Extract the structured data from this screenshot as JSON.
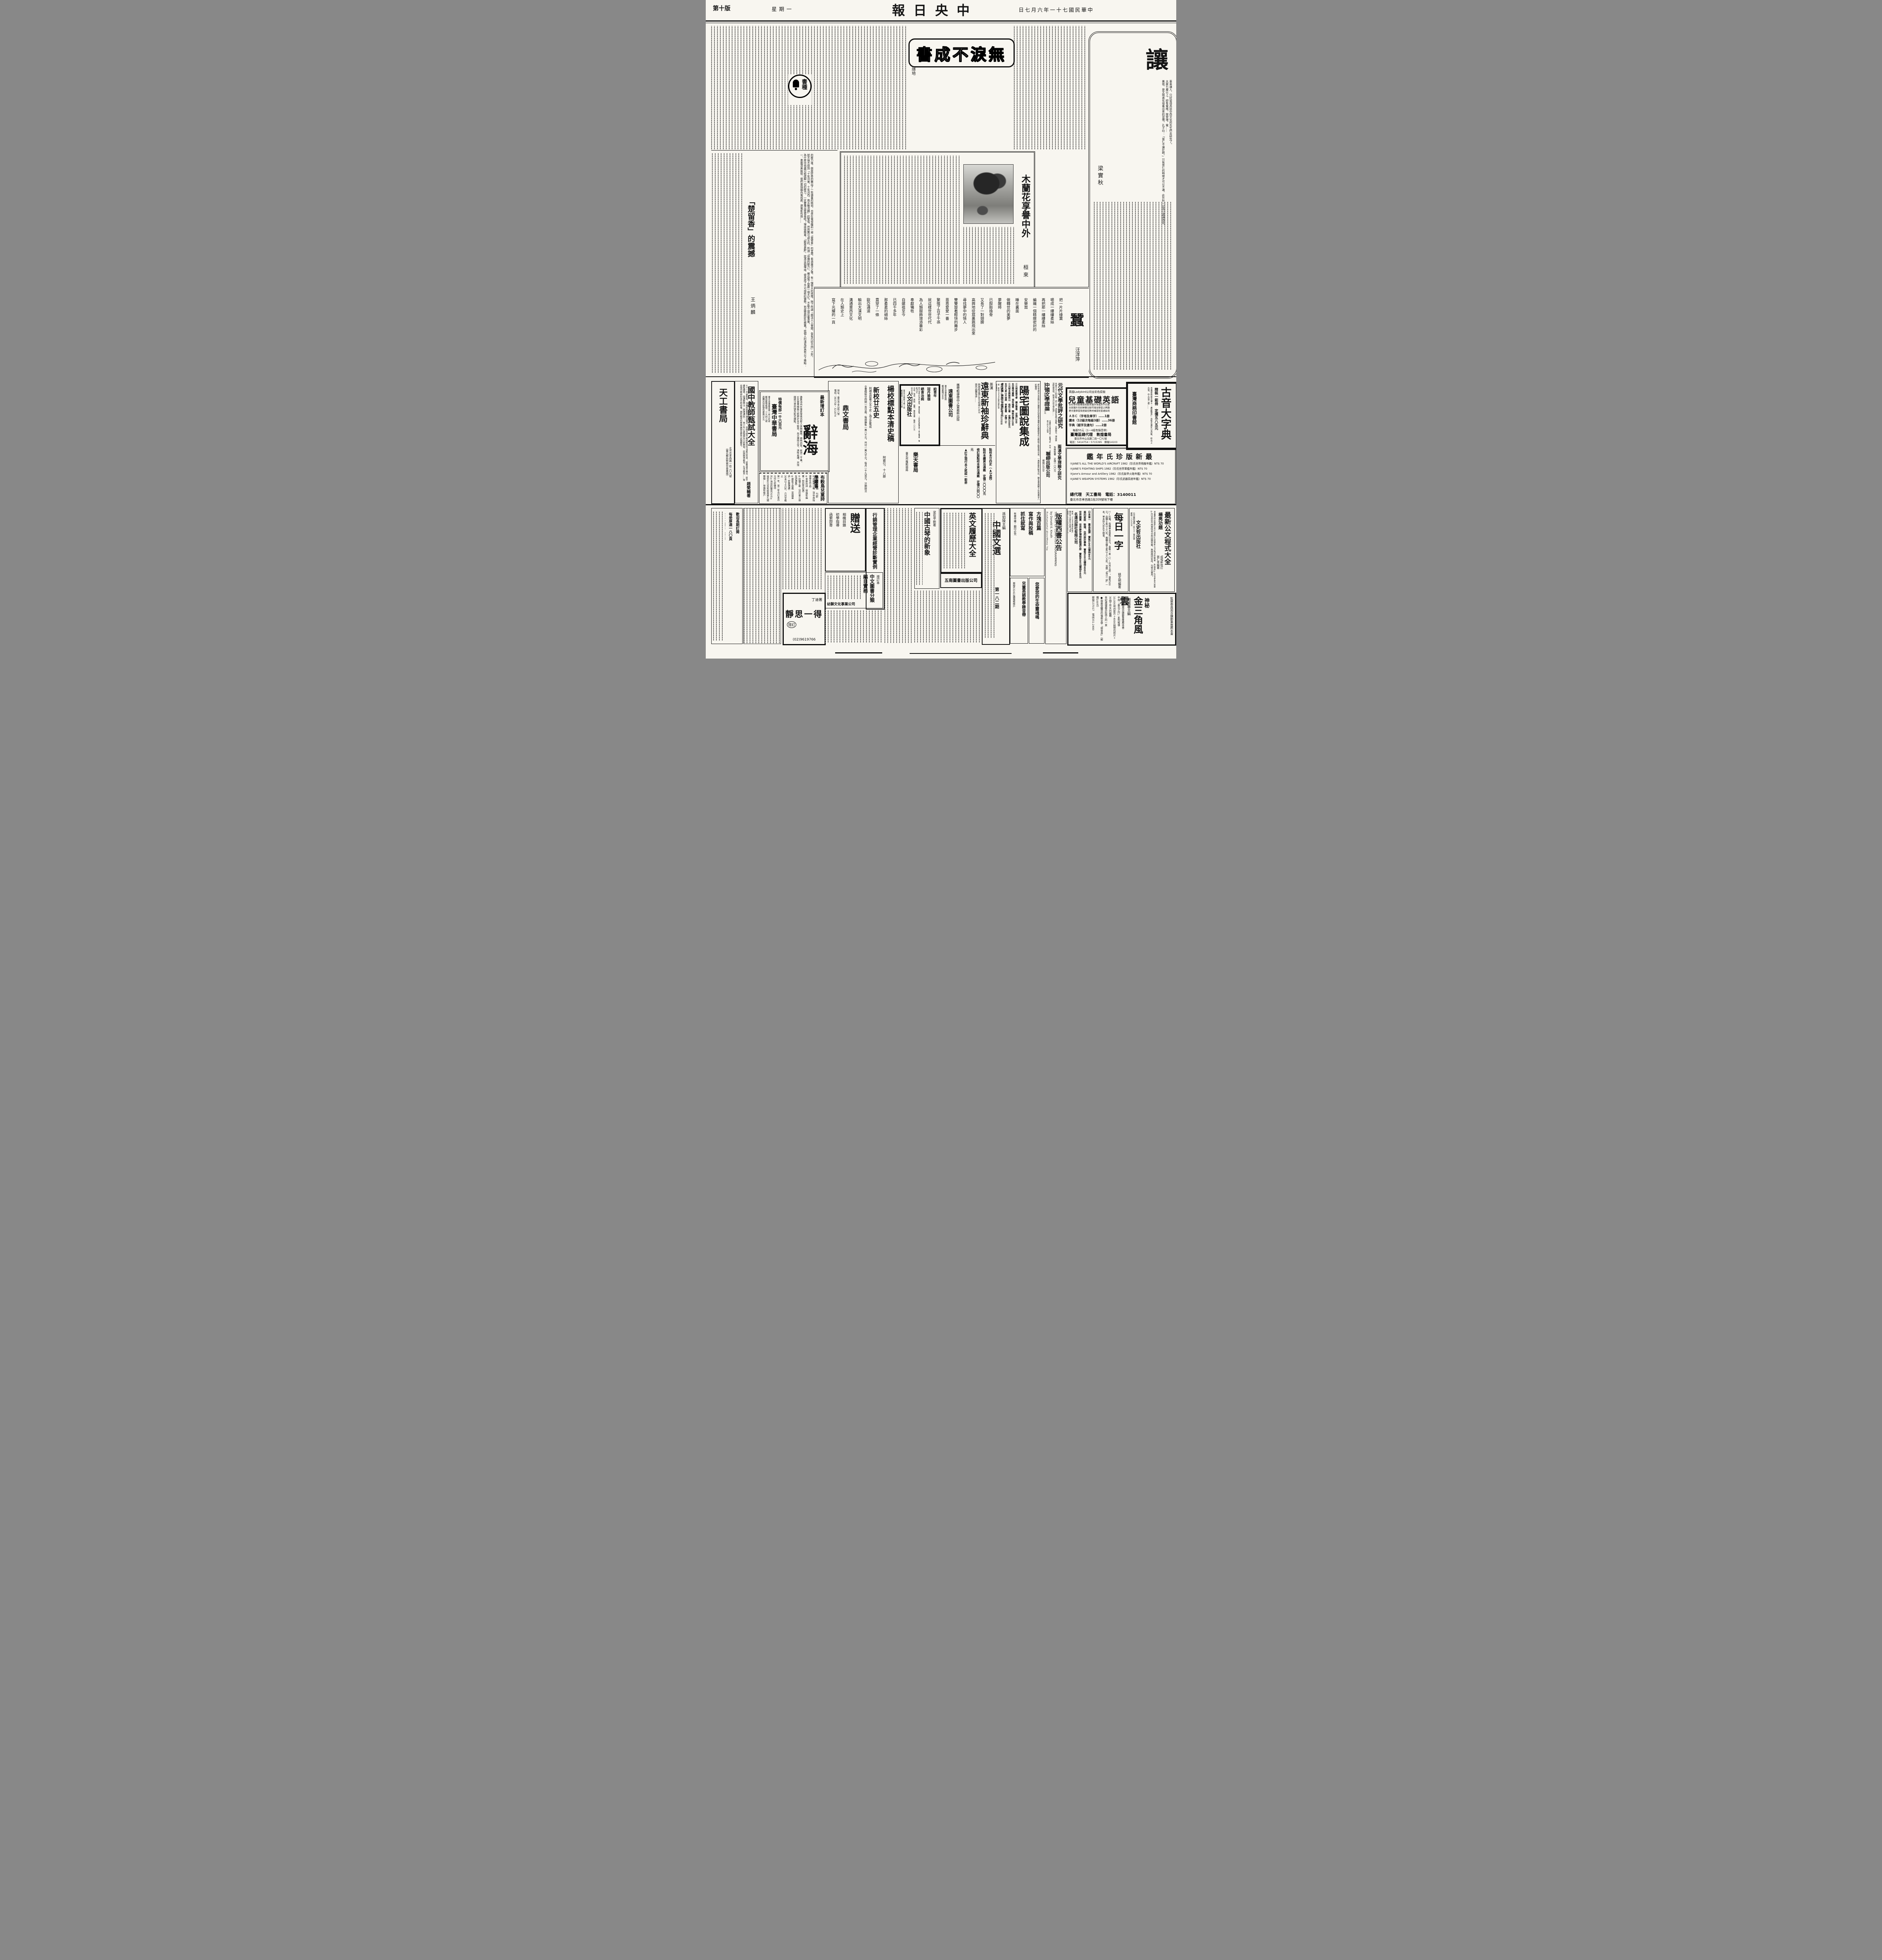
{
  "header": {
    "edition": "第十版",
    "weekday": "星期一",
    "masthead_display": "報日央中",
    "date_display": "日七月六年一十七國民華中"
  },
  "seal": {
    "text": "書種"
  },
  "art": {
    "rang": {
      "title": "讓",
      "author": "梁實秋",
      "body": [
        "車車讓人，只好留待高談中西文化的先生們去研究了。",
        "大廈七層以上，卽有電梯。按常理，電……",
        "美德，是文明進化培養出來的習慣。孔子曰：「當仁不讓於師。」只有當仁的時候才可以不讓。此外則一定當以謙讓為宜。"
      ]
    },
    "wulei": {
      "title_display": "書成不淚無",
      "author": "隱地"
    },
    "mulan": {
      "title": "木蘭花享譽中外",
      "author": "桓來"
    },
    "chu": {
      "title": "「楚留香」的震撼",
      "author": "王炳麟",
      "body": [
        "的壓力後，倒是好奇的騰出了一些讀書的時刻，也坐在電視機前一窺「楚留香」的堂奧，看過幾次之後，有一個很大的感慨，除了所謂「戲法人人會變，各有巧妙不同」之外，",
        "就不得不想到「十年河東，十年河西，風水輪流轉」的警惕，然而無可諱言的，所謂「停播的壓力」，確也幫了楚劇一個大忙，不能不說這是事實。",
        "為什麼中視盡可能疏解一切的壓力，一定要播出楚留香呢？理由很簡單，「觀眾喜歡」，就憑這個理由，便造成了不可排拒的優勢，到底楚劇好在那裏？就個人的淺見認為有以下幾點：",
        "一、畫面清美脫俗：我們覺得國內電視劇、連電影包括……"
      ]
    },
    "poem": {
      "title": "蠶",
      "author": "汪洋萍",
      "lines": [
        "把一片片綠葉",
        "嚼成一縷縷柔絲",
        "再把那一縷縷柔絲",
        "編織一個精緻密封的",
        "安樂窩",
        "睡在裏面",
        "做轉世的美夢",
        "夢醒時",
        "已脫胎換骨",
        "又長了一對翅膀",
        "高興地從窩裏跳飛出來",
        "尋找夢中的情人",
        "雙雙旋着輕快的舞步",
        "恩恩愛愛一番",
        "繁殖了百子千孫",
        "就這樣世世代代",
        "為人類服飾增添華彩",
        "奉獻犧牲",
        "自嫘祖至今",
        "已四千多年",
        "那柔柔的細絲",
        "貫穿了一條",
        "歐亞通道",
        "輸出大漢文明",
        "溝通東西文化",
        "在人類史上",
        "寫下光耀的一頁"
      ]
    }
  },
  "top": {
    "tiangong": {
      "name": "天工書局",
      "lines": [
        "北市忠孝西路一段二〇九號",
        "（臺北郵局對面中華書城）"
      ]
    },
    "guozhong": {
      "title": "國中教師甄試大全",
      "author": "趙榮輔著",
      "body": "七十一年最新版，本書依據臺灣省及臺北、高雄市國中教師甄試科目編訂而成：國教基本概念、國中課程標準、普通教學法（原理通則）、青少年心身發展及公民教育、民族精神教育、生活教育……等並增列教師的責任和修養，國民教育科教案編製及歷年試題解答。"
    },
    "cihai": {
      "pre": "最新增訂本",
      "title": "辭海",
      "body": "邀集海內外專家學者百餘人參與編務，費時四年，耗資二千萬。16K豪華精裝三鉅册計五千餘頁，內文選排大字，清晰易讀，另加國語注音符號及新式標點。",
      "price": "特價每部一千六百元",
      "pub": "臺灣中華書局",
      "lines": [
        "臺北市重慶南路一段九四號",
        "郵政劃撥帳號：三九四二號",
        "函購另加掛號包裹費56元"
      ]
    },
    "bugu": {
      "title": "布穀鳥兒童詩學叢書",
      "sub": "林煥彰主編　七折",
      "items": [
        "③母鴨帶小鴨（洪中周指導學生作品）",
        "④季節的詩（林煥彰編著・附四季詩選）",
        "⑤鈴鐺之歌（沈玲裳小朋友詩選集）",
        "⑥跟影子遊戲（英國童詩・舒蘭選譯）",
        "30本以上六折，六月廿截止",
        "第一年、第二年合訂本百元均七折優待",
        "另①海浪的聲音70元②祕密60元及布穀鳥第九期",
        "郵撥……林煥彰帳戶"
      ]
    },
    "dingwen": {
      "t1": "楊校標點本清史稿",
      "s1": "附索引，十八册",
      "t2": "新校廿五史",
      "s2": "附補充原著之五十史・為正史集成",
      "body": "全書精裝廿四開一百廿册，每部廉售一萬八千元，共付一萬九千元，每月一千九百元，分期辦法",
      "pub": "鼎文書局",
      "lines": [
        "地址：臺北市金山街八號",
        "電話：393758・321874"
      ]
    },
    "renwen": {
      "titles": [
        "給青年",
        "冠丹瑜珈",
        "絕食治病",
        "斷食",
        "我的絕食心得"
      ],
      "details": [
        "時代青年的良師益友，暮鼓晨鐘。—談德智體羣美—朱孟實著　每册50元",
        "去病、強身、美容、益壽。陳盈潔著　每册一〇〇元",
        "段木干著　每册50元",
        "55篇實驗　每册50元",
        "郭金水譯　每册50元"
      ],
      "pub": "人文出版社",
      "lines": [
        "臺中市忠明路20巷11號",
        "郵政劃匯二八〇〇〇號"
      ]
    },
    "letian": {
      "items": [
        "點校本廿四史（▲24開）",
        "點校本續資治通鑑　定價二〇〇〇元",
        "修訂版點校本資治通鑑　定價六四〇〇元",
        "▲訂正現行本之訛誤一鉅册"
      ],
      "pub": "樂天書局",
      "addr": "臺北市羅斯福路"
    },
    "yuandong": {
      "tag": "攜帶輕便懷中之寶最新出版",
      "small": "英漢",
      "title": "遠東新袖珍辭典",
      "body": [
        "辭典紙定價180元特價135元",
        "國內函購每册……"
      ],
      "pub": "遠東圖書公司",
      "lines": [
        "臺北市重慶南路",
        "郵政劃撥5669"
      ]
    },
    "yangzhai": {
      "title": "陽宅圖說集成",
      "preview": "把住宅與河水道路山丘橋樑巨石怪樹池塘等的各種關係均以精繪之圖表現出來，一看卽能判斷吉凶，購本書再購下列各書享八折優待",
      "note": "預約陸佰元至月底止　鐘友聯編・梁詩涵繪圖",
      "books": [
        "三元飛星陽宅學　鐘友聯著　定價1200",
        "玄空陽宅闡微　張哲鳴著　精裝定價1200",
        "三元秘本劈破荊山　侯松江著　定價2500元",
        "玄空九星山水祕典　李獻堂著　定價二千",
        "樓宅真機　精裝巨册特價1200元",
        "祕笈救敗全書　楊救貧著　售三千元",
        "三元修行法語64頁郵3元寄臺北51附54信箱"
      ],
      "contact": [
        "贈　郵撥104266石室出版社收",
        "書目備索"
      ]
    },
    "lianjing": {
      "b1": "元代文學批評之研究",
      "body1": "本書凡元人的別集、詩人評、詞曲評皆盡力蒐集，大量論文，博採衆說較論長短，盼望元代的文學批評……",
      "b2": "中國文學理論",
      "credit2": "劉若愚著・杜國清譯　定價一五〇元",
      "note2": "全國各大書局均售・郵購9折　門市：北市新生南路三段九十四號",
      "b3": "兩漢文學理論之研究",
      "credit3": "朱榮智著　定價一〇〇元",
      "pub": "聯經出版公司",
      "post": "郵撥10559"
    },
    "ladybird": {
      "header": "英國Ladybird公司全彩色原版",
      "title": "兒童基礎英語",
      "lines": [
        "從初學到能看能說能寫循序漸進系列完整",
        "全部圖片色彩鮮艷生動可增加學習之興趣",
        "是兒童學習英語最佳教材補習班普遍採用"
      ],
      "items": [
        "ＡＢＣ（字母及單字）……1册",
        "讀本（12級次每級3册）……36册",
        "字典（認字及連句）……2册"
      ],
      "note": "每册55元（1—4級有錄音帶）",
      "agent": "臺灣區總代理　敦煌書局",
      "addr": "臺北市中山北路二段一〇七號",
      "tel": "電話：5414754・5715395　郵撥14103"
    },
    "guyin": {
      "title": "古音大字典",
      "sub": "精裝一鉅冊　定價五八五元",
      "body": "本書係根據沈兼士「廣韻聲系」及黎氏書加以改編，綜合上古音、中古音二者……",
      "pub": "臺灣商務印書館"
    },
    "janes": {
      "title_display": "鑑年氏珍版新最",
      "items": [
        "①JANE'S ALL THE WORLD'S AIRCRAFT 1982（珍氏世界飛機年鑑）NT$ 70",
        "②JANE'S FIGHTING SHIPS 1982（珍氏世界軍艦年鑑）NT$ 70",
        "③Jane's Armour and Artillery 1982（珍氏裝甲火砲年鑑）NT$ 70",
        "④JANE'S WEAPON SYSTEMS 1982（珍氏武器系統年鑑）NT$ 70"
      ],
      "agent": "總代理　天工書局　電話：3140011",
      "addr": "臺北市忠孝西路1段209號地下樓"
    }
  },
  "bot": {
    "gongwen": {
      "title": "最新公文程式大全",
      "calligraphy": "楊亮功題",
      "credits": [
        "成惕軒校訂",
        "張仁青編著"
      ],
      "body": "本書悉依民國63年行政院訂定最新公文程式而編著，附錄有①20至64年試題②65至69年高普特考全部試題答案，無論應試從政，均極切實用。",
      "pub": "文史哲出版社",
      "lines": [
        "北市羅斯福路一段七十二巷四號",
        "郵撥一六九九五"
      ]
    },
    "meiri": {
      "title": "每日一字",
      "author": "姚文明編著",
      "body": "㈠—㈤輯，每輯單本實售100元，盒裝一套（㈠—㈤共五册），實售500元，函購十套以上八折，團體合購五套以上八五折，並贈「每日一諺」一本，單本除九折外不贈書。"
    },
    "mingyuan": {
      "books": [
        "日本第一　蕭長風譯　實售100元優待80元",
        "美的家庭　裝璜、住的設計專集　實售500元優待400元",
        "世界國寶　世界歷史博物館精選2册　實售800元優待640元"
      ],
      "pub": "名遠出版社有限公司",
      "lines": [
        "郵撥：523665黃啓彬帳戶",
        "臺北市士林區文林路79號",
        "電話：八八一〇八二五一六"
      ]
    },
    "banquan": {
      "title": "版權西書公告",
      "lines": [
        "THE ART OF COMPUTER PROGRAMMING",
        "by Donald E. Knuth",
        "Fundamental Algorithms 2/e",
        "Sorting and Searching"
      ]
    },
    "jin": {
      "tag": "神秘",
      "title": "金三角風雲",
      "editor": "趙滋蕃主編",
      "lines": [
        "監察委員周百鍊鄭重推薦本書",
        "中視「泰北之行」系列報導",
        "10,000呎的影片＋4000餘幀的照片＋30個工作天的編輯",
        "世紀邊城最悲壯感人的一頁",
        "●與最受矚目的傷痕文學「戀世界」（郵購100元）",
        "郵撥137017　電話351-2480"
      ]
    },
    "sanshu": {
      "titles": [
        "方塊百篇",
        "寫作與投稿",
        "抓住就寫"
      ],
      "note": "有著作權・翻印必究"
    },
    "zhongwenxuan": {
      "editor": "孫如陵主編",
      "title": "中國文選",
      "issue": "第一八二期"
    },
    "ertong": {
      "title": "兒童英語教學錄音帶",
      "note": "郵撥632422魏羅敏帳戶"
    },
    "shengming": {
      "title": "您愛您的生命靈魂嗎"
    },
    "guqin": {
      "credit": "梁在平新著",
      "title": "中國古琴的新象"
    },
    "yingwen": {
      "title": "英文履歷大全"
    },
    "wunan": {
      "pub": "五南圖書出版公司"
    },
    "xingxiao": {
      "title": "行銷管理企業經營診斷實例"
    },
    "zengsong": {
      "title": "贈送",
      "lines": [
        "相機目錄",
        "初學指導",
        "函索卽寄"
      ]
    },
    "youshi": {
      "pre": "增訂本",
      "title": "中文圖書分類編目實務",
      "pub": "幼獅文化事業公司"
    },
    "jingsi": {
      "author": "丁迪著",
      "title": "靜思一得",
      "edition": "增訂",
      "tel": "(02)9619766"
    },
    "subscribe": {
      "lines": [
        "歡迎長期訂閱",
        "每册厚達一八〇頁",
        "全年六期彩色精印",
        "每册定價一〇〇元"
      ]
    }
  }
}
